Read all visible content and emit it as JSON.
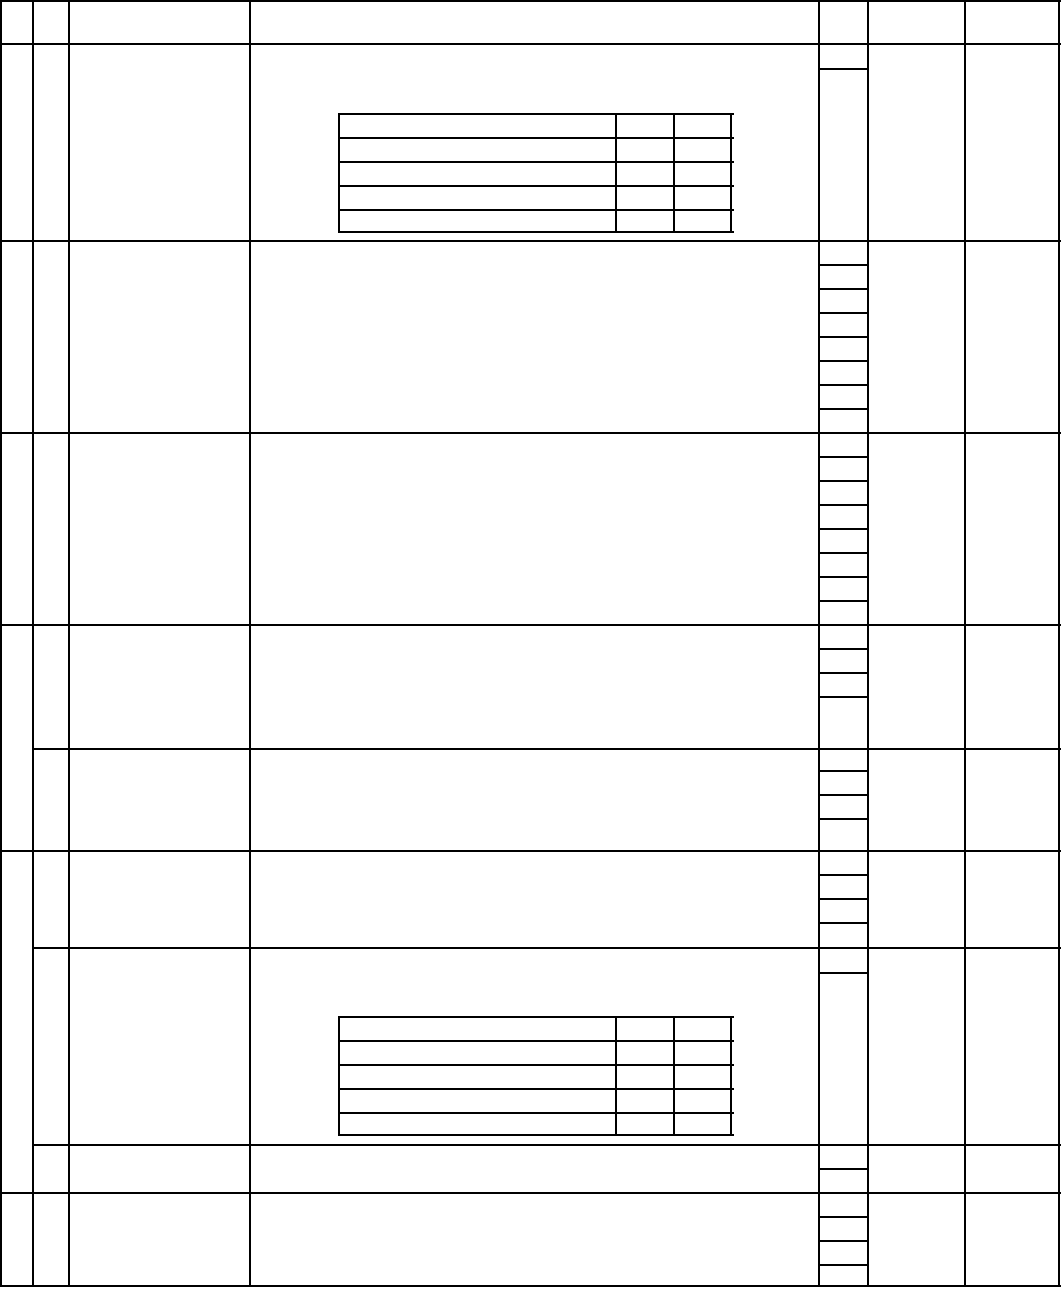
{
  "page": {
    "width": 1061,
    "height": 1289,
    "background_color": "#ffffff",
    "content": "blank multi-row form table, no visible text"
  },
  "grid": {
    "line_color": "#000000",
    "line_width": 2,
    "v_lines": [
      {
        "group": "main-table-border-left",
        "x": 0,
        "y1": 0,
        "y2": 1285
      },
      {
        "group": "main-table-col-1",
        "x": 32,
        "y1": 0,
        "y2": 1285
      },
      {
        "group": "main-table-col-2",
        "x": 68,
        "y1": 0,
        "y2": 1285
      },
      {
        "group": "main-table-col-3",
        "x": 249,
        "y1": 0,
        "y2": 1285
      },
      {
        "group": "main-table-col-4",
        "x": 818,
        "y1": 0,
        "y2": 1285
      },
      {
        "group": "main-table-col-5",
        "x": 867,
        "y1": 0,
        "y2": 1285
      },
      {
        "group": "main-table-col-6",
        "x": 964,
        "y1": 0,
        "y2": 1285
      },
      {
        "group": "main-table-border-right",
        "x": 1058,
        "y1": 0,
        "y2": 1285
      },
      {
        "group": "inner-table-1",
        "x": 338,
        "y1": 113,
        "y2": 231
      },
      {
        "group": "inner-table-1",
        "x": 615,
        "y1": 113,
        "y2": 231
      },
      {
        "group": "inner-table-1",
        "x": 673,
        "y1": 113,
        "y2": 231
      },
      {
        "group": "inner-table-1",
        "x": 730,
        "y1": 113,
        "y2": 231
      },
      {
        "group": "inner-table-2",
        "x": 338,
        "y1": 1016,
        "y2": 1134
      },
      {
        "group": "inner-table-2",
        "x": 615,
        "y1": 1016,
        "y2": 1134
      },
      {
        "group": "inner-table-2",
        "x": 673,
        "y1": 1016,
        "y2": 1134
      },
      {
        "group": "inner-table-2",
        "x": 730,
        "y1": 1016,
        "y2": 1134
      }
    ],
    "h_lines": [
      {
        "group": "main-table-border-top",
        "y": 0,
        "x1": 0,
        "x2": 1060
      },
      {
        "group": "main-table-row",
        "y": 43,
        "x1": 0,
        "x2": 1060
      },
      {
        "group": "main-table-row",
        "y": 240,
        "x1": 0,
        "x2": 1060
      },
      {
        "group": "main-table-row",
        "y": 432,
        "x1": 0,
        "x2": 1060
      },
      {
        "group": "main-table-row",
        "y": 624,
        "x1": 0,
        "x2": 1060
      },
      {
        "group": "main-table-row-partial",
        "y": 748,
        "x1": 32,
        "x2": 1060
      },
      {
        "group": "main-table-row",
        "y": 850,
        "x1": 0,
        "x2": 1060
      },
      {
        "group": "main-table-row-partial",
        "y": 947,
        "x1": 32,
        "x2": 1060
      },
      {
        "group": "main-table-row-partial",
        "y": 1144,
        "x1": 32,
        "x2": 1060
      },
      {
        "group": "main-table-row",
        "y": 1192,
        "x1": 0,
        "x2": 1060
      },
      {
        "group": "main-table-border-bottom",
        "y": 1285,
        "x1": 0,
        "x2": 1060
      },
      {
        "group": "results-column-tick",
        "y": 68,
        "x1": 818,
        "x2": 867
      },
      {
        "group": "results-column-tick",
        "y": 264,
        "x1": 818,
        "x2": 867
      },
      {
        "group": "results-column-tick",
        "y": 288,
        "x1": 818,
        "x2": 867
      },
      {
        "group": "results-column-tick",
        "y": 312,
        "x1": 818,
        "x2": 867
      },
      {
        "group": "results-column-tick",
        "y": 336,
        "x1": 818,
        "x2": 867
      },
      {
        "group": "results-column-tick",
        "y": 360,
        "x1": 818,
        "x2": 867
      },
      {
        "group": "results-column-tick",
        "y": 384,
        "x1": 818,
        "x2": 867
      },
      {
        "group": "results-column-tick",
        "y": 408,
        "x1": 818,
        "x2": 867
      },
      {
        "group": "results-column-tick",
        "y": 456,
        "x1": 818,
        "x2": 867
      },
      {
        "group": "results-column-tick",
        "y": 480,
        "x1": 818,
        "x2": 867
      },
      {
        "group": "results-column-tick",
        "y": 504,
        "x1": 818,
        "x2": 867
      },
      {
        "group": "results-column-tick",
        "y": 528,
        "x1": 818,
        "x2": 867
      },
      {
        "group": "results-column-tick",
        "y": 552,
        "x1": 818,
        "x2": 867
      },
      {
        "group": "results-column-tick",
        "y": 576,
        "x1": 818,
        "x2": 867
      },
      {
        "group": "results-column-tick",
        "y": 600,
        "x1": 818,
        "x2": 867
      },
      {
        "group": "results-column-tick",
        "y": 648,
        "x1": 818,
        "x2": 867
      },
      {
        "group": "results-column-tick",
        "y": 672,
        "x1": 818,
        "x2": 867
      },
      {
        "group": "results-column-tick",
        "y": 696,
        "x1": 818,
        "x2": 867
      },
      {
        "group": "results-column-tick",
        "y": 770,
        "x1": 818,
        "x2": 867
      },
      {
        "group": "results-column-tick",
        "y": 794,
        "x1": 818,
        "x2": 867
      },
      {
        "group": "results-column-tick",
        "y": 818,
        "x1": 818,
        "x2": 867
      },
      {
        "group": "results-column-tick",
        "y": 874,
        "x1": 818,
        "x2": 867
      },
      {
        "group": "results-column-tick",
        "y": 898,
        "x1": 818,
        "x2": 867
      },
      {
        "group": "results-column-tick",
        "y": 922,
        "x1": 818,
        "x2": 867
      },
      {
        "group": "results-column-tick",
        "y": 972,
        "x1": 818,
        "x2": 867
      },
      {
        "group": "results-column-tick",
        "y": 1168,
        "x1": 818,
        "x2": 867
      },
      {
        "group": "results-column-tick",
        "y": 1216,
        "x1": 818,
        "x2": 867
      },
      {
        "group": "results-column-tick",
        "y": 1240,
        "x1": 818,
        "x2": 867
      },
      {
        "group": "results-column-tick",
        "y": 1264,
        "x1": 818,
        "x2": 867
      },
      {
        "group": "inner-table-1",
        "y": 113,
        "x1": 338,
        "x2": 732
      },
      {
        "group": "inner-table-1",
        "y": 137,
        "x1": 338,
        "x2": 732
      },
      {
        "group": "inner-table-1",
        "y": 161,
        "x1": 338,
        "x2": 732
      },
      {
        "group": "inner-table-1",
        "y": 185,
        "x1": 338,
        "x2": 732
      },
      {
        "group": "inner-table-1",
        "y": 209,
        "x1": 338,
        "x2": 732
      },
      {
        "group": "inner-table-1",
        "y": 231,
        "x1": 338,
        "x2": 732
      },
      {
        "group": "inner-table-2",
        "y": 1016,
        "x1": 338,
        "x2": 732
      },
      {
        "group": "inner-table-2",
        "y": 1040,
        "x1": 338,
        "x2": 732
      },
      {
        "group": "inner-table-2",
        "y": 1064,
        "x1": 338,
        "x2": 732
      },
      {
        "group": "inner-table-2",
        "y": 1088,
        "x1": 338,
        "x2": 732
      },
      {
        "group": "inner-table-2",
        "y": 1112,
        "x1": 338,
        "x2": 732
      },
      {
        "group": "inner-table-2",
        "y": 1134,
        "x1": 338,
        "x2": 732
      }
    ]
  }
}
